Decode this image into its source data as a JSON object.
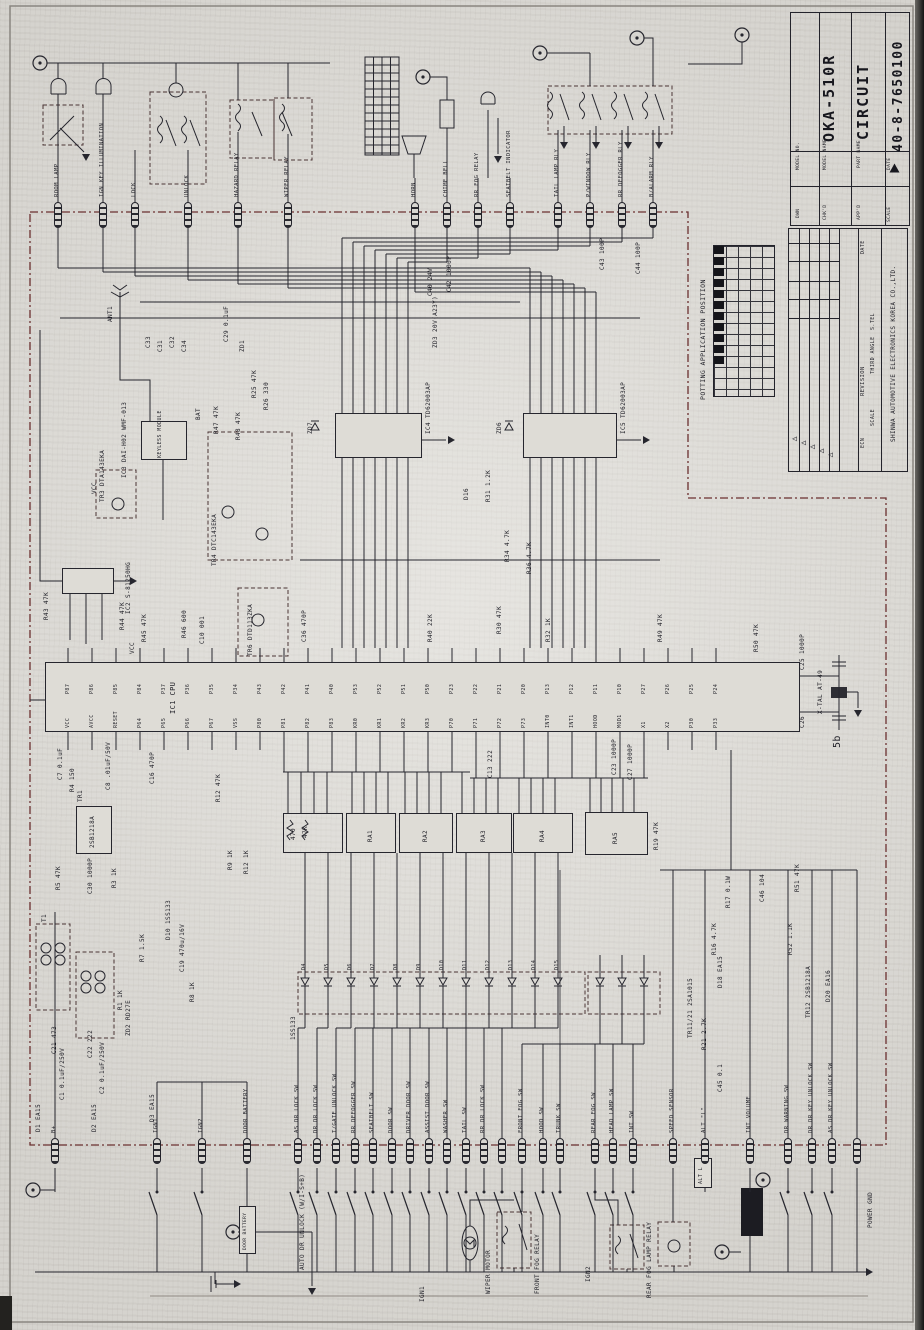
{
  "title_block": {
    "model_no_label": "MODEL NO.",
    "model_name_label": "MODEL NAME",
    "model_name": "OKA-510R",
    "part_name_label": "PART NAME",
    "part_name": "CIRCUIT",
    "drawing_no": "40-8-7650100",
    "dwn_label": "DWN",
    "chk_label": "CHK'D",
    "app_label": "APP'D",
    "date_label": "DATE",
    "scale_label": "SCALE"
  },
  "rev_block": {
    "date_label": "DATE",
    "revision_label": "REVISION",
    "ecn_label": "ECN",
    "stel_label": "S.TEL",
    "angle_label": "THIRD ANGLE",
    "scale_label": "SCALE",
    "company": "SHINWA AUTOMOTIVE ELECTRONICS KOREA CO.,LTD.",
    "mark_glyph": "◁"
  },
  "potting": {
    "caption": "POTTING APPLICATION POSITION"
  },
  "blocks": {
    "cpu_ref": "IC1 CPU",
    "keyless_label": "KEYLESS MODULE",
    "door_battery_label": "DOOR BATTERY",
    "alt_label": "ALT L"
  },
  "ra_labels": [
    "RA1",
    "RA2",
    "RA3",
    "RA4",
    "RA5"
  ],
  "top_pins": {
    "items": [
      {
        "label": "ROOM LAMP",
        "x": 58
      },
      {
        "label": "IGN KEY ILLUMINATION",
        "x": 103
      },
      {
        "label": "LOCK",
        "x": 135
      },
      {
        "label": "UNLOCK",
        "x": 188
      },
      {
        "label": "HAZARD RELAY",
        "x": 238
      },
      {
        "label": "WIPER RELAY",
        "x": 288
      },
      {
        "label": "HORN",
        "x": 415
      },
      {
        "label": "CHIME BELL",
        "x": 447
      },
      {
        "label": "RR FOG RELAY",
        "x": 478
      },
      {
        "label": "SEATBELT INDICATOR",
        "x": 510
      },
      {
        "label": "TAIL LAMP RLY",
        "x": 558
      },
      {
        "label": "P/WINDOW RLY",
        "x": 590
      },
      {
        "label": "RR DEFOGGER RLY",
        "x": 622
      },
      {
        "label": "B/ALARM RLY",
        "x": 653
      }
    ]
  },
  "bottom_pins": {
    "items": [
      {
        "label": "AS DR LOCK SW",
        "x": 298,
        "sw": 1
      },
      {
        "label": "DR DR LOCK SW",
        "x": 317,
        "sw": 1
      },
      {
        "label": "T/GATE UNLOCK SW",
        "x": 336,
        "sw": 1
      },
      {
        "label": "RR DEFOGGER SW",
        "x": 355,
        "sw": 1
      },
      {
        "label": "SEATBELT SW",
        "x": 373,
        "sw": 1
      },
      {
        "label": "DOOR SW",
        "x": 392,
        "sw": 1
      },
      {
        "label": "DRIVER DOOR SW",
        "x": 410,
        "sw": 1
      },
      {
        "label": "ASSIST DOOR SW",
        "x": 429,
        "sw": 1
      },
      {
        "label": "WASHER SW",
        "x": 447,
        "sw": 1
      },
      {
        "label": "TAIL SW",
        "x": 466,
        "sw": 1
      },
      {
        "label": "RR DR LOCK SW",
        "x": 484,
        "sw": 1
      },
      {
        "label": "",
        "x": 502,
        "sw": 1
      },
      {
        "label": "FRONT FOG SW",
        "x": 522,
        "sw": 1
      },
      {
        "label": "HOOD SW",
        "x": 543,
        "sw": 1
      },
      {
        "label": "TRUNK SW",
        "x": 560,
        "sw": 1
      },
      {
        "label": "REAR FOG SW",
        "x": 595,
        "sw": 1
      },
      {
        "label": "HEAD LAMP SW",
        "x": 613,
        "sw": 1
      },
      {
        "label": "INT SW",
        "x": 633,
        "sw": 1
      },
      {
        "label": "SPEED SENSOR",
        "x": 673,
        "sw": 0
      },
      {
        "label": "ALT \"L\"",
        "x": 705,
        "sw": 0
      },
      {
        "label": "INT VOLUME",
        "x": 750,
        "sw": 0
      },
      {
        "label": "DR WARNING SW",
        "x": 788,
        "sw": 1
      },
      {
        "label": "DR DR KEY UNLOCK SW",
        "x": 812,
        "sw": 1
      },
      {
        "label": "AS DR KEY UNLOCK SW",
        "x": 832,
        "sw": 1
      },
      {
        "label": "",
        "x": 857,
        "sw": 0
      }
    ]
  },
  "left_pins": {
    "items": [
      {
        "label": "B+",
        "x": 55,
        "sw": 0
      },
      {
        "label": "IGN1",
        "x": 157,
        "sw": 1
      },
      {
        "label": "IGN2",
        "x": 202,
        "sw": 1
      },
      {
        "label": "DOOR BATTERY",
        "x": 247,
        "sw": 0
      }
    ]
  },
  "cpu_pins": {
    "top": [
      "P87",
      "P86",
      "P85",
      "P84",
      "P37",
      "P36",
      "P35",
      "P34",
      "P43",
      "P42",
      "P41",
      "P40",
      "P53",
      "P52",
      "P51",
      "P50",
      "P23",
      "P22",
      "P21",
      "P20",
      "P13",
      "P12",
      "P11",
      "P10",
      "P27",
      "P26",
      "P25",
      "P24"
    ],
    "bottom": [
      "VCC",
      "AVCC",
      "RESET",
      "P64",
      "P65",
      "P66",
      "P67",
      "VSS",
      "P80",
      "P81",
      "P82",
      "P83",
      "KR0",
      "KR1",
      "KR2",
      "KR3",
      "P70",
      "P71",
      "P72",
      "P73",
      "INT0",
      "INT1",
      "HOOD",
      "MOD1",
      "X1",
      "X2",
      "P30",
      "P33"
    ]
  },
  "diode_refs": [
    "D4",
    "D5",
    "D6",
    "D7",
    "D8",
    "D9",
    "D10",
    "D11",
    "D12",
    "D13",
    "D14",
    "D15"
  ],
  "misc_refs": [
    {
      "t": "ANT1",
      "x": 108,
      "y": 322
    },
    {
      "t": "C33",
      "x": 146,
      "y": 348
    },
    {
      "t": "C31",
      "x": 158,
      "y": 352
    },
    {
      "t": "C32",
      "x": 170,
      "y": 348
    },
    {
      "t": "C34",
      "x": 182,
      "y": 352
    },
    {
      "t": "C29 0.1uF",
      "x": 224,
      "y": 342
    },
    {
      "t": "ZD1",
      "x": 240,
      "y": 352
    },
    {
      "t": "R25 47K",
      "x": 252,
      "y": 398
    },
    {
      "t": "R26 330",
      "x": 264,
      "y": 410
    },
    {
      "t": "IC3 DAI-H02 WMF-013",
      "x": 122,
      "y": 478
    },
    {
      "t": "TR3 DTA143EKA",
      "x": 100,
      "y": 502
    },
    {
      "t": "BAT",
      "x": 196,
      "y": 420
    },
    {
      "t": "R47 47K",
      "x": 214,
      "y": 434
    },
    {
      "t": "R48 47K",
      "x": 236,
      "y": 440
    },
    {
      "t": "VCC",
      "x": 92,
      "y": 494
    },
    {
      "t": "TR4 DTC143EKA",
      "x": 212,
      "y": 566
    },
    {
      "t": "ZD7",
      "x": 308,
      "y": 434
    },
    {
      "t": "IC4 TD62003AP",
      "x": 426,
      "y": 434
    },
    {
      "t": "ZD6",
      "x": 497,
      "y": 434
    },
    {
      "t": "IC5 TD62003AP",
      "x": 621,
      "y": 434
    },
    {
      "t": "D16",
      "x": 464,
      "y": 500
    },
    {
      "t": "R31 1.2K",
      "x": 486,
      "y": 502
    },
    {
      "t": "R34 4.7K",
      "x": 505,
      "y": 562
    },
    {
      "t": "R36 4.7K",
      "x": 527,
      "y": 574
    },
    {
      "t": "C36 470P",
      "x": 302,
      "y": 642
    },
    {
      "t": "TR6 DTD113ZKA",
      "x": 248,
      "y": 656
    },
    {
      "t": "IC2 S-81250HG",
      "x": 126,
      "y": 614
    },
    {
      "t": "R43 47K",
      "x": 44,
      "y": 620
    },
    {
      "t": "R44 47K",
      "x": 120,
      "y": 630
    },
    {
      "t": "R45 47K",
      "x": 142,
      "y": 642
    },
    {
      "t": "R46 600",
      "x": 182,
      "y": 638
    },
    {
      "t": "C10 001",
      "x": 200,
      "y": 644
    },
    {
      "t": "VCC",
      "x": 130,
      "y": 654
    },
    {
      "t": "R40 22K",
      "x": 428,
      "y": 642
    },
    {
      "t": "R30 47K",
      "x": 497,
      "y": 634
    },
    {
      "t": "R32 1K",
      "x": 546,
      "y": 642
    },
    {
      "t": "R49 47K",
      "x": 658,
      "y": 642
    },
    {
      "t": "R50 47K",
      "x": 754,
      "y": 652
    },
    {
      "t": "X-TAL AT-49",
      "x": 818,
      "y": 714
    },
    {
      "t": "C25 1000P",
      "x": 800,
      "y": 670
    },
    {
      "t": "C26",
      "x": 800,
      "y": 728
    },
    {
      "t": "5b",
      "x": 833,
      "y": 748,
      "fs": 10
    },
    {
      "t": "C40 24V",
      "x": 428,
      "y": 296
    },
    {
      "t": "C42 1000P",
      "x": 447,
      "y": 292
    },
    {
      "t": "ZD3 20V(A23Y)",
      "x": 433,
      "y": 348
    },
    {
      "t": "C43 100P",
      "x": 600,
      "y": 270
    },
    {
      "t": "C44 100P",
      "x": 636,
      "y": 274
    },
    {
      "t": "C7 0.1uF",
      "x": 58,
      "y": 780
    },
    {
      "t": "C8 .01uF/50V",
      "x": 106,
      "y": 790
    },
    {
      "t": "R4 150",
      "x": 70,
      "y": 792
    },
    {
      "t": "C16 470P",
      "x": 150,
      "y": 784
    },
    {
      "t": "R12 47K",
      "x": 216,
      "y": 802
    },
    {
      "t": "R9 1K",
      "x": 228,
      "y": 870
    },
    {
      "t": "R12 1K",
      "x": 244,
      "y": 874
    },
    {
      "t": "470",
      "x": 291,
      "y": 840
    },
    {
      "t": "47K",
      "x": 303,
      "y": 838
    },
    {
      "t": "R19 47K",
      "x": 654,
      "y": 850
    },
    {
      "t": "C13 222",
      "x": 488,
      "y": 778
    },
    {
      "t": "C23 1000P",
      "x": 612,
      "y": 775
    },
    {
      "t": "C27 1000P",
      "x": 628,
      "y": 780
    },
    {
      "t": "R5 47K",
      "x": 56,
      "y": 890
    },
    {
      "t": "C30 1000P",
      "x": 88,
      "y": 894
    },
    {
      "t": "R3 1K",
      "x": 112,
      "y": 888
    },
    {
      "t": "D10 1SS133",
      "x": 166,
      "y": 940
    },
    {
      "t": "R7 1.5K",
      "x": 140,
      "y": 962
    },
    {
      "t": "R8 1K",
      "x": 190,
      "y": 1002
    },
    {
      "t": "R1 1K",
      "x": 118,
      "y": 1010
    },
    {
      "t": "ZD2 RD27E",
      "x": 126,
      "y": 1036
    },
    {
      "t": "C19 470u/16V",
      "x": 180,
      "y": 972
    },
    {
      "t": "T1",
      "x": 42,
      "y": 922
    },
    {
      "t": "C21 473",
      "x": 52,
      "y": 1054
    },
    {
      "t": "C22 222",
      "x": 88,
      "y": 1058
    },
    {
      "t": "C1 0.1uF/250V",
      "x": 60,
      "y": 1100
    },
    {
      "t": "C2 0.1uF/250V",
      "x": 100,
      "y": 1094
    },
    {
      "t": "D1 EA15",
      "x": 36,
      "y": 1132
    },
    {
      "t": "D2 EA15",
      "x": 92,
      "y": 1132
    },
    {
      "t": "D3 EA15",
      "x": 150,
      "y": 1122
    },
    {
      "t": "1SS133",
      "x": 291,
      "y": 1040
    },
    {
      "t": "TR11/21 2SA1015",
      "x": 688,
      "y": 1038
    },
    {
      "t": "R21 2.7K",
      "x": 702,
      "y": 1050
    },
    {
      "t": "C45 0.1",
      "x": 718,
      "y": 1092
    },
    {
      "t": "R16 4.7K",
      "x": 712,
      "y": 955
    },
    {
      "t": "R17 0.1W",
      "x": 726,
      "y": 908
    },
    {
      "t": "R51 47K",
      "x": 795,
      "y": 892
    },
    {
      "t": "R52 1.1K",
      "x": 788,
      "y": 955
    },
    {
      "t": "TR12 2SB1218A",
      "x": 806,
      "y": 1018
    },
    {
      "t": "D20 EA16",
      "x": 826,
      "y": 1002
    },
    {
      "t": "D18 EA15",
      "x": 718,
      "y": 988
    },
    {
      "t": "C46 104",
      "x": 760,
      "y": 902
    },
    {
      "t": "POWER GND",
      "x": 868,
      "y": 1228
    },
    {
      "t": "AUTO DR UNLOCK (W/I-S+B)",
      "x": 300,
      "y": 1270
    },
    {
      "t": "WIPER MOTOR",
      "x": 486,
      "y": 1294
    },
    {
      "t": "FRONT FOG RELAY",
      "x": 535,
      "y": 1294
    },
    {
      "t": "REAR FOG LAMP RELAY",
      "x": 647,
      "y": 1298
    },
    {
      "t": "IGN1",
      "x": 420,
      "y": 1302
    },
    {
      "t": "IGN2",
      "x": 586,
      "y": 1282
    },
    {
      "t": "2SB1218A",
      "x": 90,
      "y": 848
    },
    {
      "t": "TR1",
      "x": 78,
      "y": 802
    }
  ]
}
